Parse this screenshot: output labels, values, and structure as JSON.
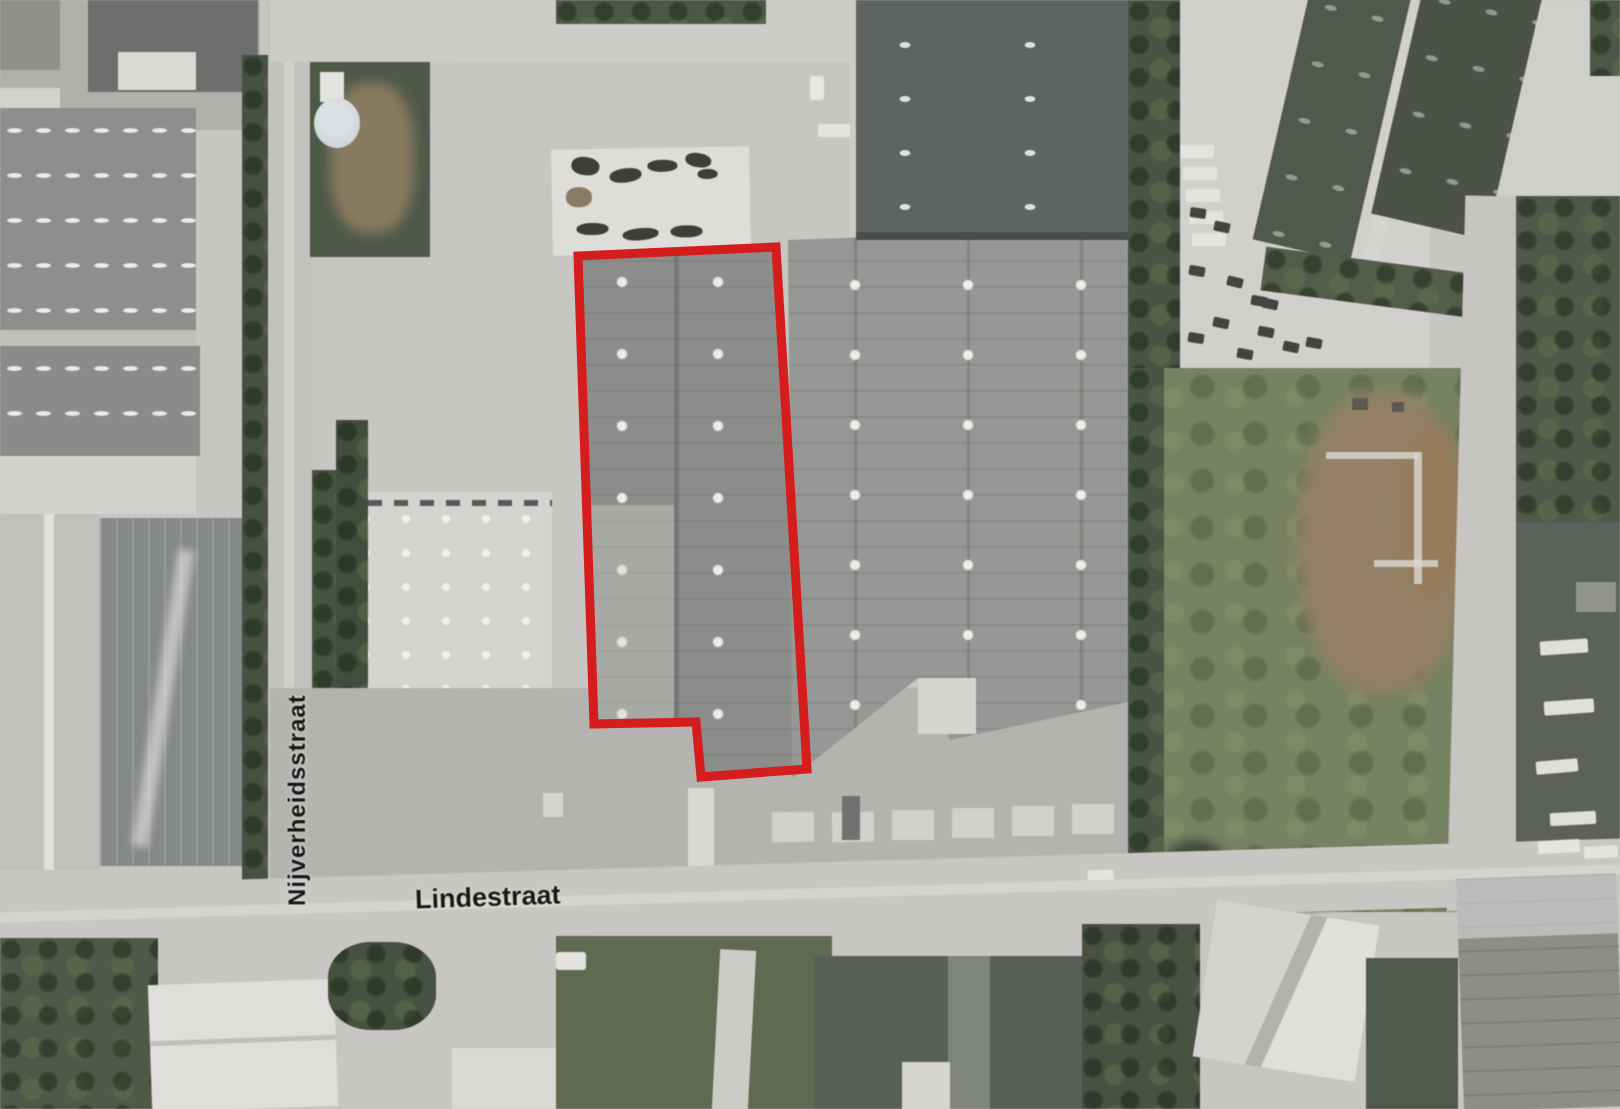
{
  "map": {
    "type": "aerial-photograph",
    "streets": {
      "horizontal_label": "Lindestraat",
      "vertical_label": "Nijverheidsstraat"
    },
    "highlight": {
      "color": "#d61d1d"
    }
  }
}
